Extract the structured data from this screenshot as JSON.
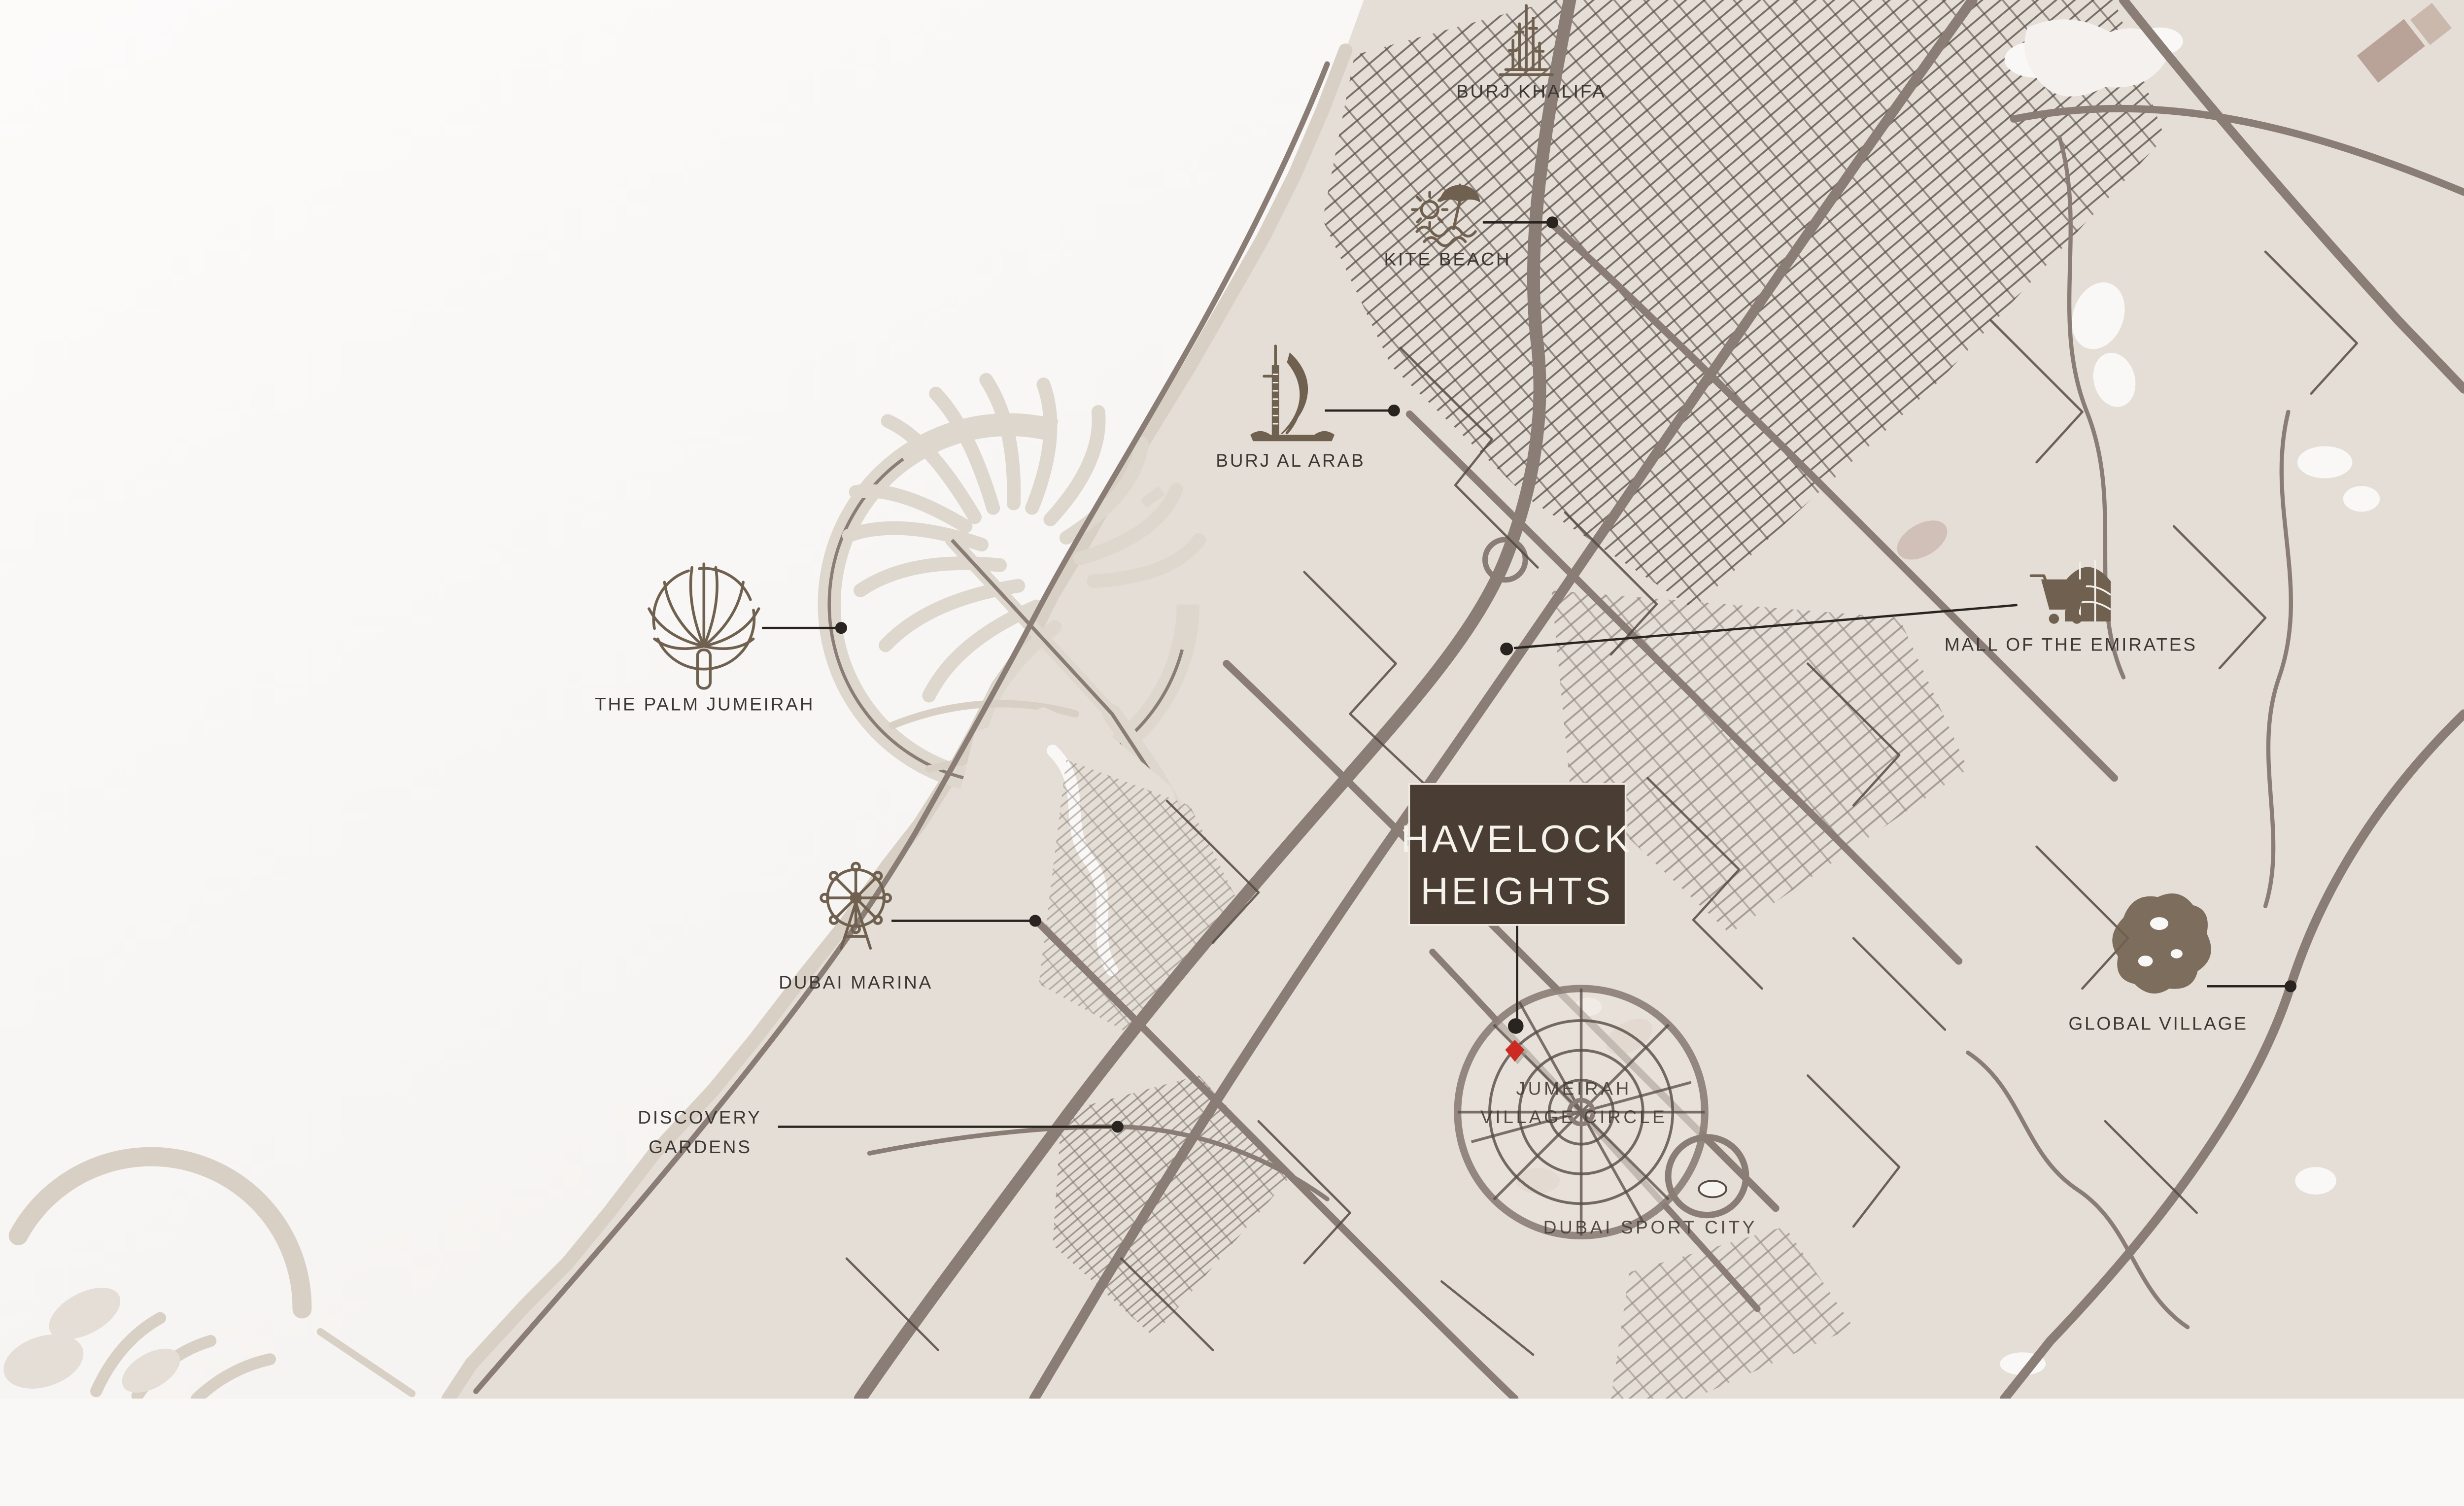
{
  "map": {
    "project": {
      "name_line1": "HAVELOCK",
      "name_line2": "HEIGHTS"
    },
    "landmarks": [
      {
        "id": "burj-khalifa",
        "label": "BURJ KHALIFA",
        "icon": "burj-khalifa-tower-icon",
        "has_leader": false
      },
      {
        "id": "kite-beach",
        "label": "KITE BEACH",
        "icon": "beach-umbrella-sun-icon",
        "has_leader": true
      },
      {
        "id": "burj-al-arab",
        "label": "BURJ AL ARAB",
        "icon": "sail-hotel-icon",
        "has_leader": true
      },
      {
        "id": "the-palm-jumeirah",
        "label": "THE PALM JUMEIRAH",
        "icon": "palm-island-icon",
        "has_leader": true
      },
      {
        "id": "mall-of-the-emirates",
        "label": "MALL OF THE EMIRATES",
        "icon": "shopping-cart-mall-icon",
        "has_leader": true
      },
      {
        "id": "dubai-marina",
        "label": "DUBAI MARINA",
        "icon": "ferris-wheel-icon",
        "has_leader": true
      },
      {
        "id": "global-village",
        "label": "GLOBAL VILLAGE",
        "icon": "globe-blob-icon",
        "has_leader": true
      },
      {
        "id": "discovery-gardens",
        "label_line1": "DISCOVERY",
        "label_line2": "GARDENS",
        "icon": "none",
        "has_leader": true
      }
    ],
    "areas": [
      {
        "id": "jumeirah-village-circle",
        "label_line1": "JUMEIRAH",
        "label_line2": "VILLAGE CIRCLE"
      },
      {
        "id": "dubai-sport-city",
        "label": "DUBAI SPORT CITY"
      }
    ],
    "marker": {
      "id": "project-location-marker",
      "shape": "red-diamond"
    },
    "colors": {
      "sea": "#f9f8f6",
      "land": "#e4ded6",
      "beach": "#d8d0c5",
      "road_major": "#8a7d76",
      "road_minor": "#564b44",
      "icon": "#70604f",
      "label": "#3c3733",
      "leader": "#29241f",
      "project_box": "#4a3d33",
      "project_text": "#f5f2ec",
      "marker_red": "#ce2a24"
    }
  }
}
